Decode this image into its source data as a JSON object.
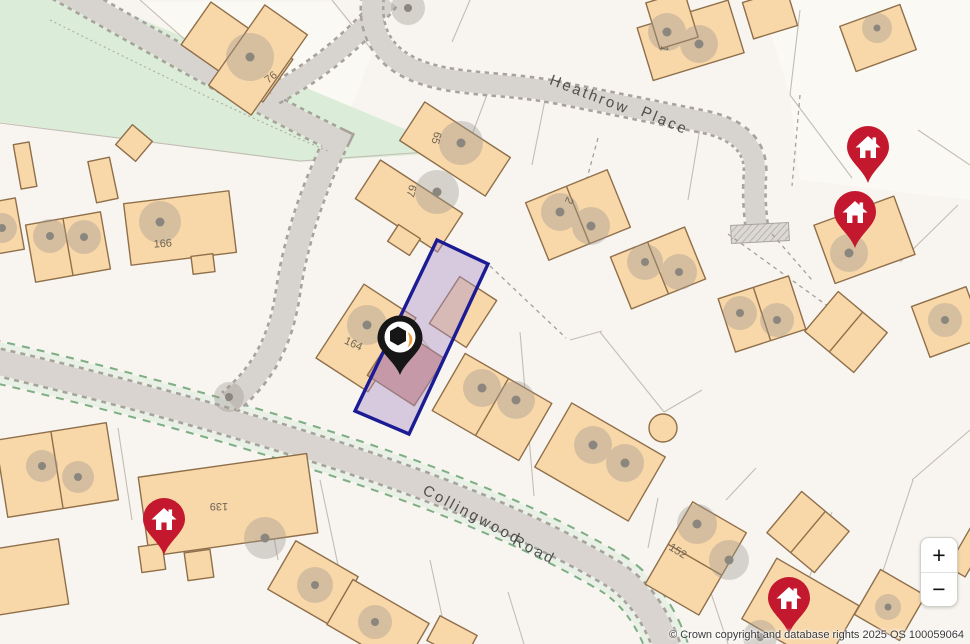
{
  "map": {
    "attribution": "© Crown copyright and database rights 2025 OS 100059064",
    "controls": {
      "zoom_in_label": "+",
      "zoom_out_label": "−"
    },
    "road_labels": {
      "heathrow": "Heathrow",
      "place": "Place",
      "collingwood": "Collingwood",
      "road": "Road"
    },
    "house_numbers": [
      "76",
      "65",
      "67",
      "166",
      "164",
      "2",
      "1",
      "139",
      "152"
    ],
    "markers": {
      "selected": {
        "type": "selected-property-pin",
        "icon": "home-cube-icon",
        "color": "#161616",
        "accent": "#ee9f3c"
      },
      "nearby": {
        "type": "property-pin",
        "icon": "home-icon",
        "color": "#c4182f",
        "count": 4
      }
    },
    "selected_plot": {
      "outline_color": "#1b1b94",
      "fill_color": "#a98fc9"
    },
    "colors": {
      "background": "#f8f5f0",
      "green_space": "#dbecd8",
      "road_fill": "#d7d3ce",
      "road_edge_dash": "#a7a29a",
      "verge_green_dash": "#7fae85",
      "building_fill": "#f8d7a9",
      "building_stroke": "#8f6f4a",
      "inner_building_fill": "#d9a091",
      "tree_symbol": "#9e9890"
    }
  }
}
